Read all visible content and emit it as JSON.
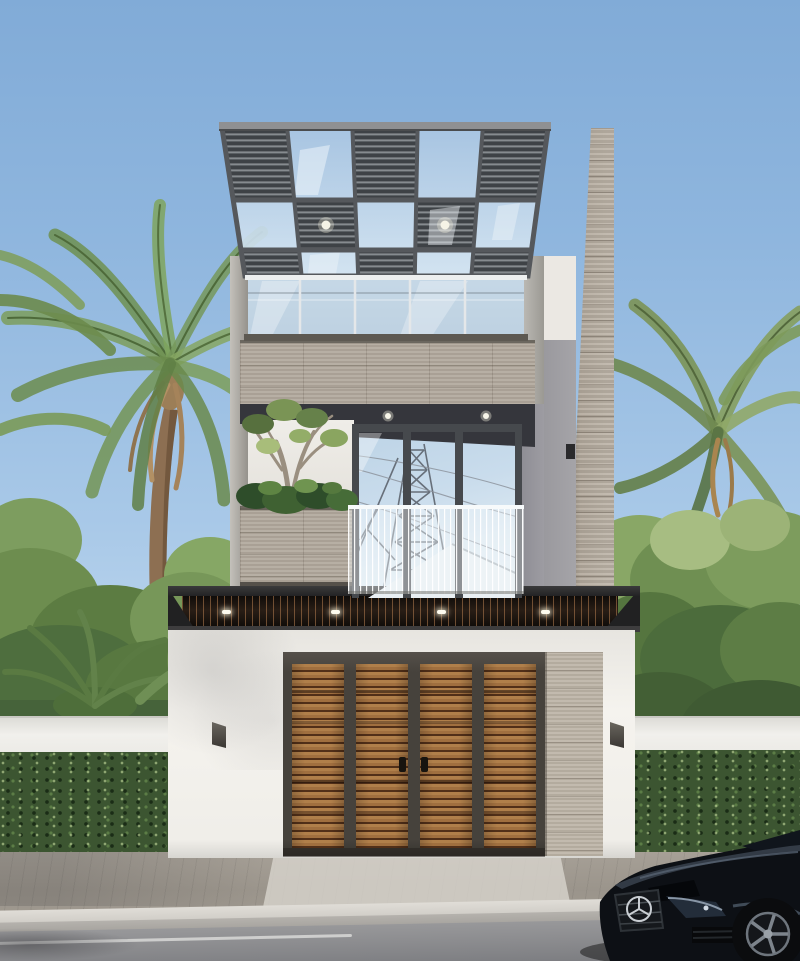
{
  "scene": {
    "kind": "3D architectural exterior render, no visible text",
    "regions": {
      "sky": "clear light blue sky",
      "vegetation": "coconut palms and dense tropical trees on both sides",
      "rooftop": "steel pergola with alternating louvre and glass panels above a glass-railed roof terrace, two round downlights",
      "third_floor": "stone tile clad parapet band",
      "second_floor": "recessed balcony, glass doors reflecting a power pylon and neighbouring roof, planter box with frangipani tree and shrubs, glass balustrade, two ceiling downlights",
      "ground_floor": "white rendered wall, dark timber-slat canopy with four downlights, four-panel timber slat gate with two handles, stone pier, two wall sconces",
      "boundary": "white boundary walls with clipped green hedges",
      "street": "brick-paved sidewalk, concrete curb, asphalt road with white edge line",
      "vehicle": "black luxury coupe front end with three-pointed star badge, lower right corner"
    },
    "counts": {
      "pergola_grid_columns": 5,
      "pergola_grid_rows": 3,
      "pergola_downlights": 2,
      "balcony_downlights": 2,
      "canopy_downlights": 4,
      "gate_panels": 4,
      "gate_handles": 2,
      "wall_sconces": 2
    },
    "palette": {
      "sky_top": "#81abd7",
      "sky_horizon": "#dcebf6",
      "pergola_frame": "#4b4f53",
      "louvre_slat": "#868b8f",
      "glass_blue": "#a6c4e0",
      "stone": "#b2a99d",
      "white_wall": "#f2f0eb",
      "soffit_dark": "#35363c",
      "canopy_dark": "#221a14",
      "gate_wood": "#a5743f",
      "gate_frame": "#4a453f",
      "foliage_green": "#6f8f4f",
      "hedge_green": "#3c5531",
      "pavement": "#c9c5bf",
      "road": "#85868a",
      "car_black": "#0d1015"
    }
  }
}
